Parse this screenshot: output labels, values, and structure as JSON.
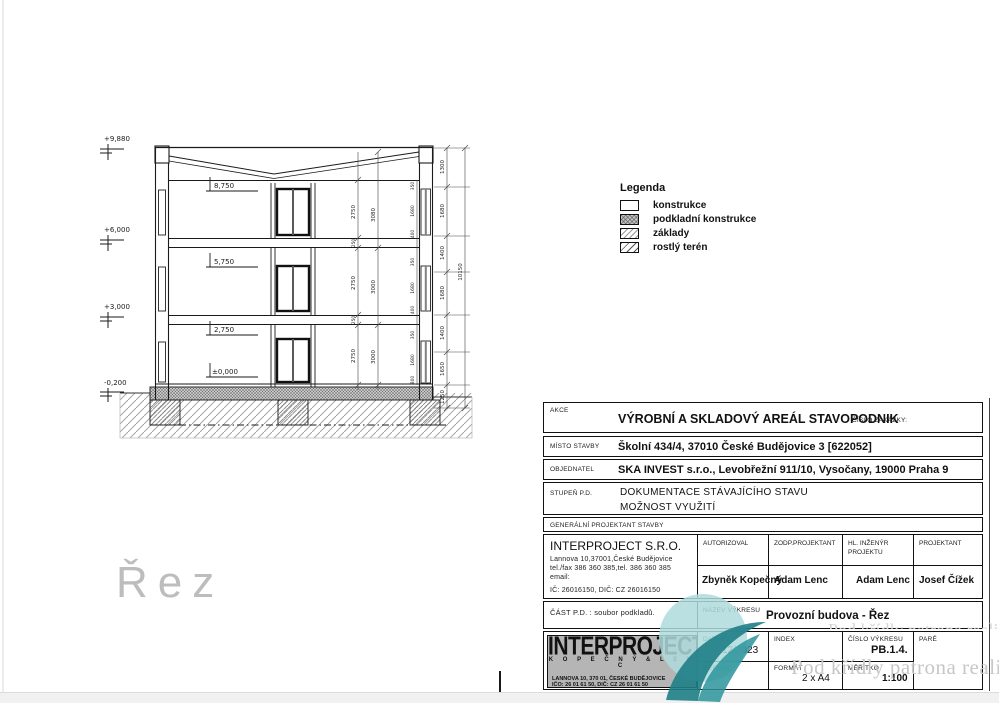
{
  "page": {
    "section_label": "Řez"
  },
  "colors": {
    "teal_dark": "#1f7e86",
    "teal_light": "#aedadd",
    "watermark_gray": "#c7c7c7",
    "logo_bg": "#b5b5b5"
  },
  "drawing": {
    "elevations": [
      {
        "label": "+9,880"
      },
      {
        "label": "+6,000"
      },
      {
        "label": "+3,000"
      },
      {
        "label": "-0,200"
      }
    ],
    "levels": [
      "8,750",
      "5,750",
      "2,750",
      "±0,000"
    ],
    "dims": {
      "floor_heights": [
        "2750",
        "2750",
        "2750"
      ],
      "slabs": [
        "250",
        "250"
      ],
      "storey": [
        "3080",
        "3000",
        "3000"
      ],
      "window_chain": [
        "350",
        "1680",
        "400",
        "350",
        "1680",
        "400",
        "350",
        "1680",
        "800"
      ],
      "mid_chain": [
        "1300",
        "1680",
        "1400",
        "1680",
        "1400",
        "1650",
        "1250"
      ],
      "overall": "10150"
    }
  },
  "legend": {
    "title": "Legenda",
    "items": [
      {
        "label": "konstrukce",
        "swatch": "solid-white"
      },
      {
        "label": "podkladní konstrukce",
        "swatch": "crosshatch-gray"
      },
      {
        "label": "základy",
        "swatch": "hatch-light"
      },
      {
        "label": "rostlý terén",
        "swatch": "hatch-diagonal"
      }
    ]
  },
  "title_block": {
    "akce_label": "AKCE",
    "akce_value": "VÝROBNÍ A SKLADOVÝ AREÁL STAVOPODNIK",
    "cislo_zakazky_label": "ČÍSLO ZAKÁZKY:",
    "misto_stavby_label": "MÍSTO STAVBY",
    "misto_stavby_value": "Školní 434/4, 37010 České Budějovice 3 [622052]",
    "objednatel_label": "OBJEDNATEL",
    "objednatel_value": "SKA INVEST s.r.o., Levobřežní 911/10, Vysočany, 19000 Praha 9",
    "stupen_label": "STUPEŇ P.D.",
    "stupen_value_1": "DOKUMENTACE STÁVAJÍCÍHO STAVU",
    "stupen_value_2": "MOŽNOST VYUŽITÍ",
    "gen_projektant_label": "GENERÁLNÍ PROJEKTANT STAVBY",
    "company": {
      "name": "INTERPROJECT S.R.O.",
      "address": "Lannova 10,37001,České Budějovice",
      "phone": "tel./fax 386 360 385,tel. 386 360 385",
      "email_label": "email:",
      "ic": "IČ: 26016150, DIČ: CZ 26016150"
    },
    "roles": [
      {
        "label": "AUTORIZOVAL",
        "value": "Zbyněk Kopečný"
      },
      {
        "label": "ZODP.PROJEKTANT",
        "value": "Adam Lenc"
      },
      {
        "label": "HL. INŽENÝR",
        "label2": "PROJEKTU",
        "value": "Adam Lenc"
      },
      {
        "label": "PROJEKTANT",
        "value": "Josef Čížek"
      }
    ],
    "cast_pd_label": "ČÁST P.D. : soubor podkladů.",
    "nazev_vykresu_label": "NÁZEV VÝKRESU",
    "nazev_vykresu_value": "Provozní budova - Řez",
    "logo": {
      "line1": "INTERPROJECT",
      "line2": "K O P E Č N Ý   &   L E N C",
      "line3": "LANNOVA 10, 370 01, ČESKÉ BUDĚJOVICE",
      "line4": "IČO: 26 01 61 50,  DIČ: CZ 26 01 61 50"
    },
    "datum_label": "DATUM",
    "datum_value": "12/2023",
    "index_label": "INDEX",
    "cislo_vykresu_label": "ČÍSLO VÝKRESU",
    "cislo_vykresu_value": "PB.1.4.",
    "pare_label": "PARÉ",
    "refcad_label": "REF.CAD",
    "format_label": "FORMÁT",
    "format_value": "2 x A4",
    "meritko_label": "MĚŘÍTKO",
    "meritko_value": "1:100"
  },
  "watermark": {
    "text": "Pod křídly patrona realit"
  }
}
